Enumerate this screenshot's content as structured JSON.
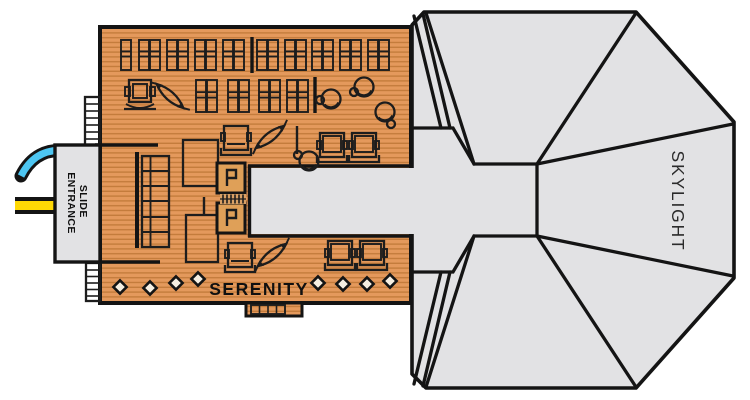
{
  "title": "Serenity deck plan with slide entrance and skylight",
  "labels": {
    "serenity": "SERENITY",
    "skylight": "SKYLIGHT",
    "slide_line1": "SLIDE",
    "slide_line2": "ENTRANCE"
  },
  "colors": {
    "outline": "#141414",
    "deck": "#E4995C",
    "plank": "#C47C3C",
    "gray": "#E2E2E4",
    "light": "#EFEFF1",
    "station": "#DFA058",
    "stairfill": "#D8A065",
    "slide_blue": "#4DC6F2",
    "slide_yellow": "#FFD905"
  },
  "furniture": {
    "lounger_rows": [
      {
        "y": 40,
        "h": 30,
        "singles": [
          121
        ],
        "pairs": [
          139,
          167,
          195,
          223,
          257,
          285,
          312,
          340,
          368
        ]
      },
      {
        "y": 80,
        "h": 32,
        "singles": [],
        "pairs": [
          196,
          228,
          259,
          287
        ]
      }
    ],
    "dividers": [
      [
        252,
        37,
        73
      ],
      [
        315,
        77,
        113
      ]
    ],
    "clamshells": [
      {
        "x": 127,
        "y": 80
      }
    ],
    "chairs": [
      {
        "x": 224,
        "y": 126
      },
      {
        "x": 228,
        "y": 243
      }
    ],
    "chair_pairs": [
      {
        "x": 320,
        "y": 133
      },
      {
        "x": 328,
        "y": 241
      }
    ],
    "hammocks": [
      {
        "cx": 170,
        "cy": 96,
        "rot": 42
      },
      {
        "cx": 270,
        "cy": 137,
        "rot": -38
      },
      {
        "cx": 272,
        "cy": 255,
        "rot": -38
      }
    ],
    "pod_chairs": [
      {
        "cx": 331,
        "cy": 99,
        "sx": -11,
        "sy": 1
      },
      {
        "cx": 364,
        "cy": 87,
        "sx": -10,
        "sy": 5
      },
      {
        "cx": 385,
        "cy": 112,
        "sx": 6,
        "sy": 12
      },
      {
        "cx": 309,
        "cy": 161,
        "sx": -11,
        "sy": -6
      }
    ],
    "diamonds": [
      [
        120,
        287
      ],
      [
        150,
        288
      ],
      [
        176,
        283
      ],
      [
        198,
        279
      ],
      [
        318,
        283
      ],
      [
        343,
        284
      ],
      [
        367,
        284
      ],
      [
        390,
        281
      ]
    ]
  }
}
